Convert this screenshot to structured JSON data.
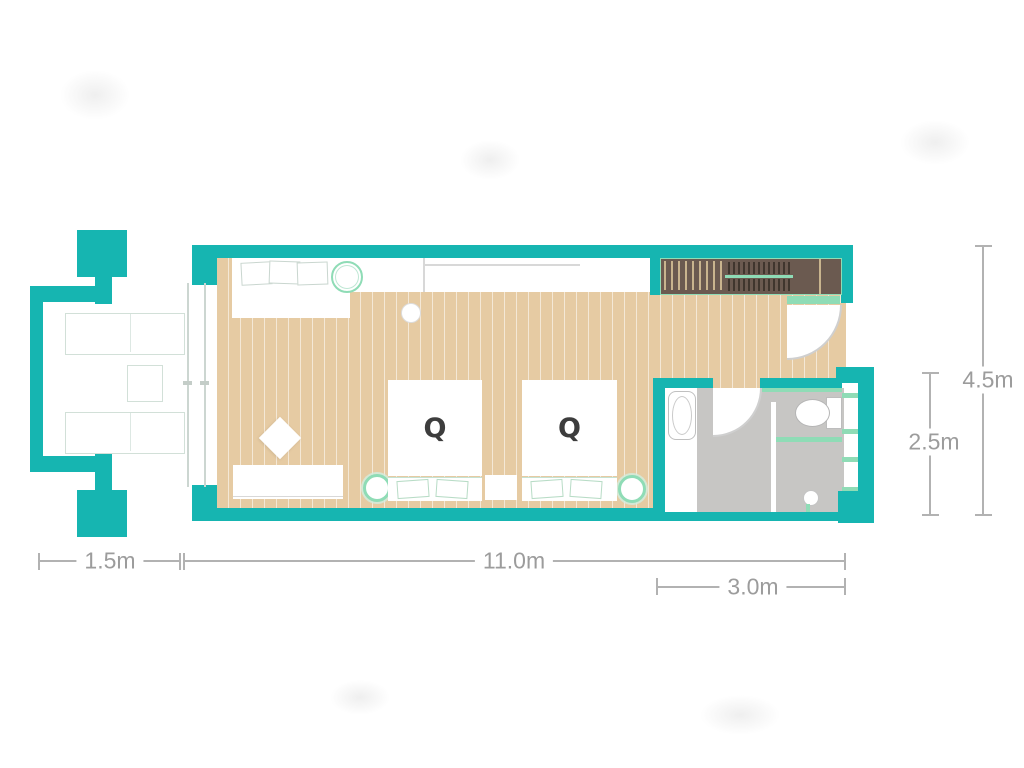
{
  "floorplan": {
    "bed_labels": {
      "bed1": "Q",
      "bed2": "Q"
    },
    "dimensions": {
      "balcony_width": "1.5m",
      "main_width": "11.0m",
      "bathroom_width": "3.0m",
      "total_depth": "4.5m",
      "bathroom_depth": "2.5m"
    },
    "colors": {
      "wall_teal": "#16b5b1",
      "floor_wood": "#e6cba3",
      "wardrobe_brown": "#6b5a50",
      "bathroom_floor_gray": "#c7c6c4",
      "accent_mint": "#8fdcb6",
      "dimension_gray": "#9c9c9c"
    }
  }
}
